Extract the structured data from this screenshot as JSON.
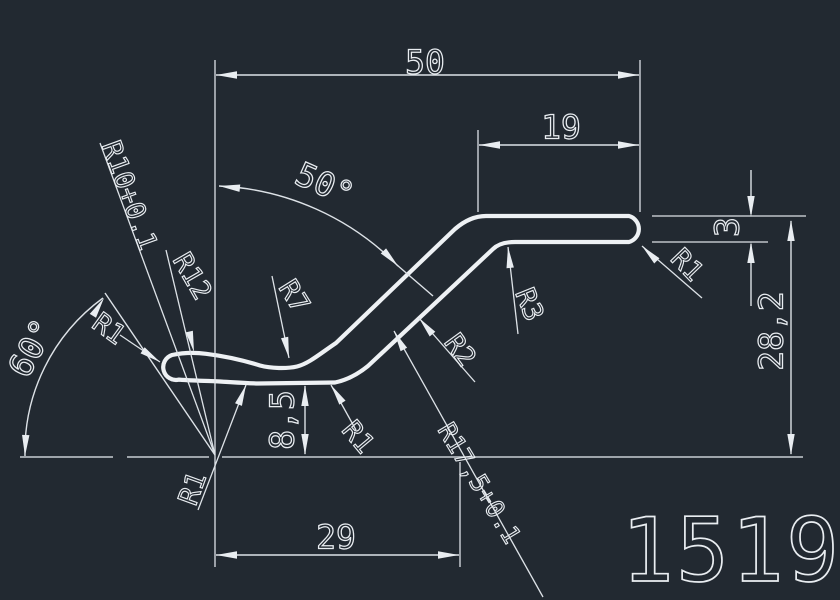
{
  "app": {
    "background": "#222931",
    "line_color": "#e9edf1"
  },
  "part": {
    "number": "1519"
  },
  "dimensions": {
    "overall_width": "50",
    "flange_width": "19",
    "base_width": "29",
    "overall_height": "28,2",
    "thickness": "3",
    "groove_depth": "8,5",
    "main_angle": "50°",
    "left_angle": "60°"
  },
  "radii": {
    "r10": "R10+0.1",
    "r12": "R12",
    "r7": "R7",
    "r1": "R1",
    "r2": "R2",
    "r3": "R3",
    "r17_5": "R17,5+0.1"
  }
}
